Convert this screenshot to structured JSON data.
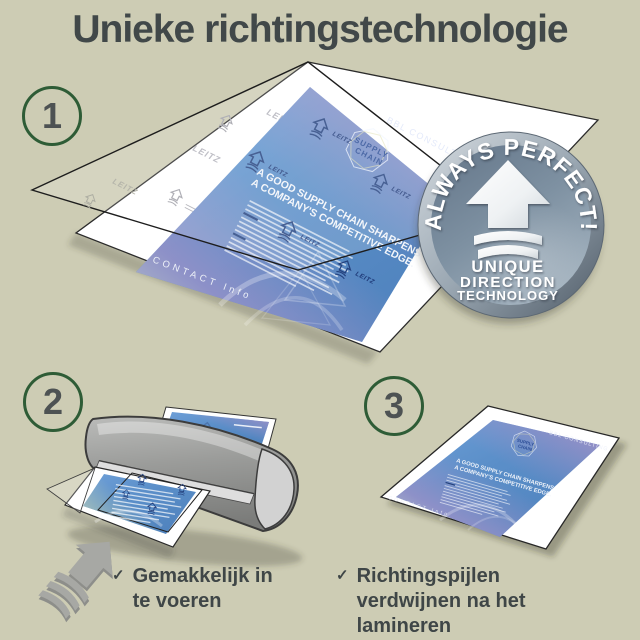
{
  "title": "Unieke richtingstechnologie",
  "steps": [
    {
      "number": "1"
    },
    {
      "number": "2"
    },
    {
      "number": "3"
    }
  ],
  "badge": {
    "arc_text": "ALWAYS PERFECT!",
    "caption_lines": [
      "UNIQUE",
      "DIRECTION",
      "TECHNOLOGY"
    ]
  },
  "document": {
    "brand": "BBL CONSULTING",
    "logo": {
      "line1": "SUPPLY",
      "line2": "CHAIN"
    },
    "headline": {
      "line1": "A GOOD SUPPLY CHAIN SHARPENS",
      "line2": "A COMPANY'S COMPETITIVE EDGE."
    },
    "footer": "CONTACT Info",
    "watermark": "LEITZ"
  },
  "check_glyph": "✓",
  "checklist": [
    {
      "icon": "checkmark",
      "text": "Gemakkelijk in te voeren"
    },
    {
      "icon": "checkmark",
      "text": "Richtingspijlen verdwijnen na het lamineren"
    }
  ],
  "colors": {
    "background": "#cdccb4",
    "text": "#414849",
    "step_green": "#2e5c36",
    "step_number": "#4d5253",
    "document_blue": "#5b8fc9",
    "badge_silver": "#8fa0af",
    "arrow_navy": "#24427f"
  }
}
